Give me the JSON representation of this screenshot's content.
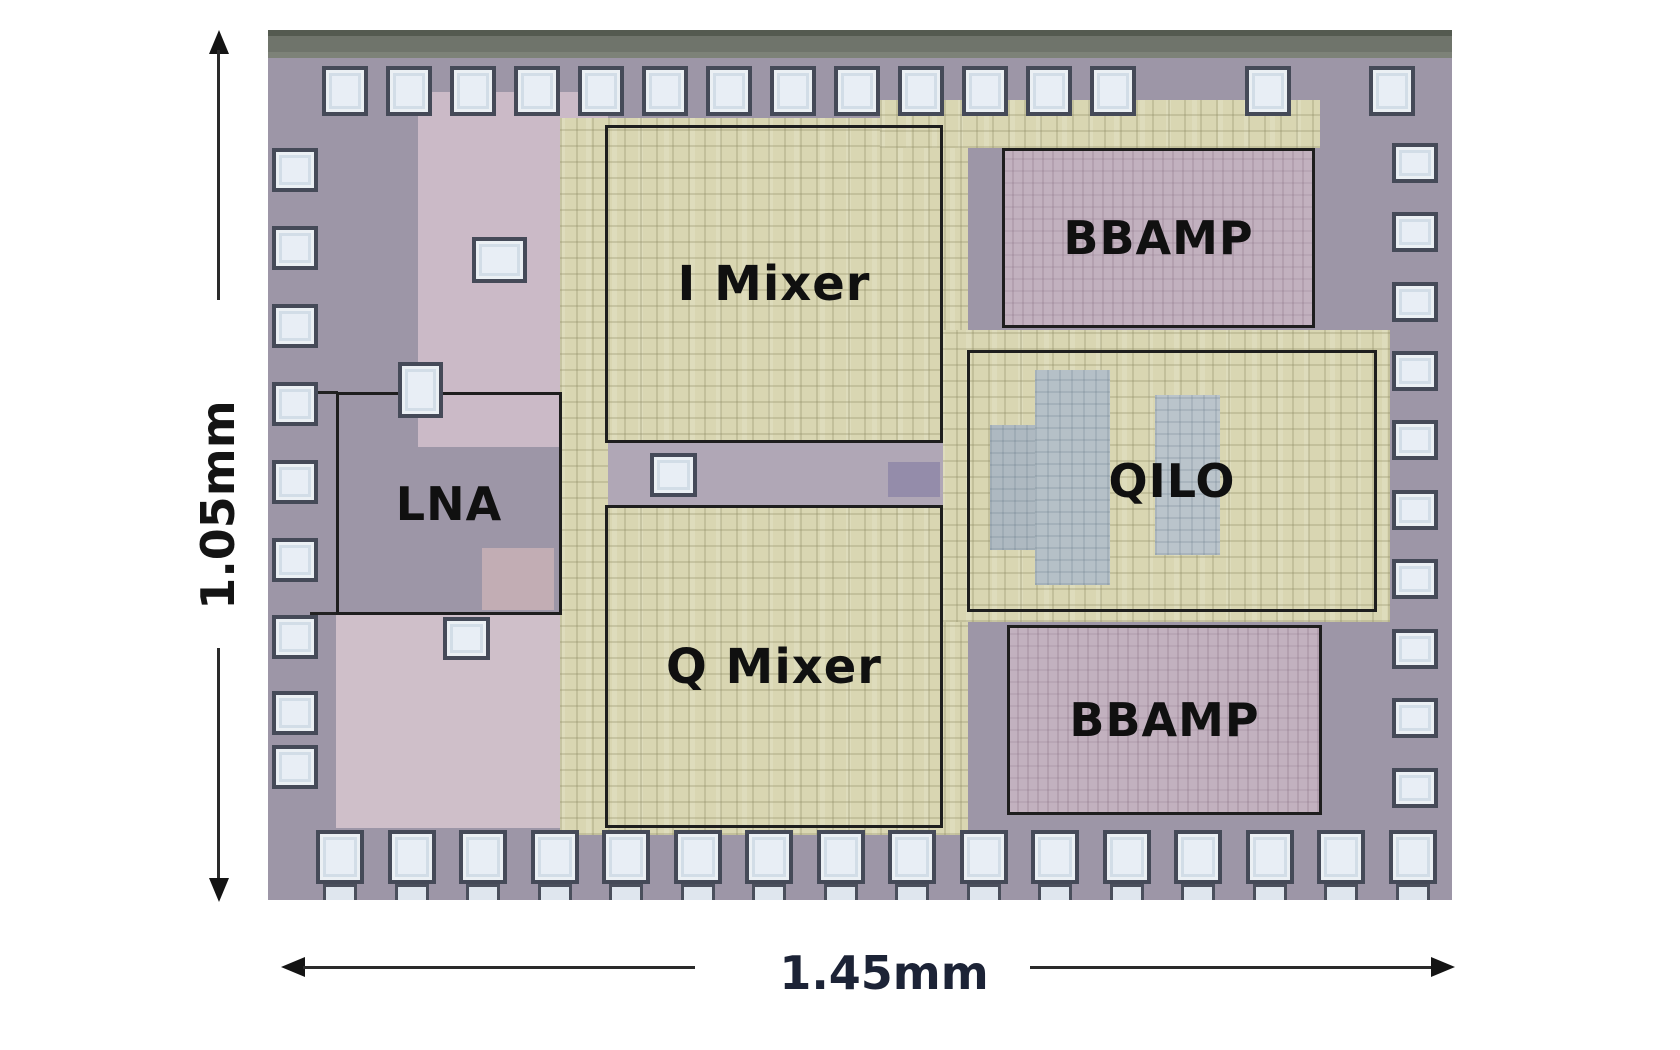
{
  "figure": {
    "type": "chip-die-micrograph",
    "blocks": [
      {
        "id": "lna",
        "label": "LNA"
      },
      {
        "id": "i-mixer",
        "label": "I Mixer"
      },
      {
        "id": "q-mixer",
        "label": "Q Mixer"
      },
      {
        "id": "bbamp-top",
        "label": "BBAMP"
      },
      {
        "id": "qilo",
        "label": "QILO"
      },
      {
        "id": "bbamp-bottom",
        "label": "BBAMP"
      }
    ],
    "dimensions": {
      "height_label": "1.05mm",
      "width_label": "1.45mm"
    },
    "colors": {
      "die_base": "#9d96a7",
      "circuit_yellow": "#d9d6b2",
      "region_pink": "#cbbac7",
      "bbamp_mauve": "#c2b1bf",
      "qilo_blue_patch": "#b5c0c7",
      "pad_fill": "#e8eef5",
      "pad_border": "#454a58",
      "outline_black": "#1e1e1e",
      "dimension_text": "#141414"
    }
  }
}
